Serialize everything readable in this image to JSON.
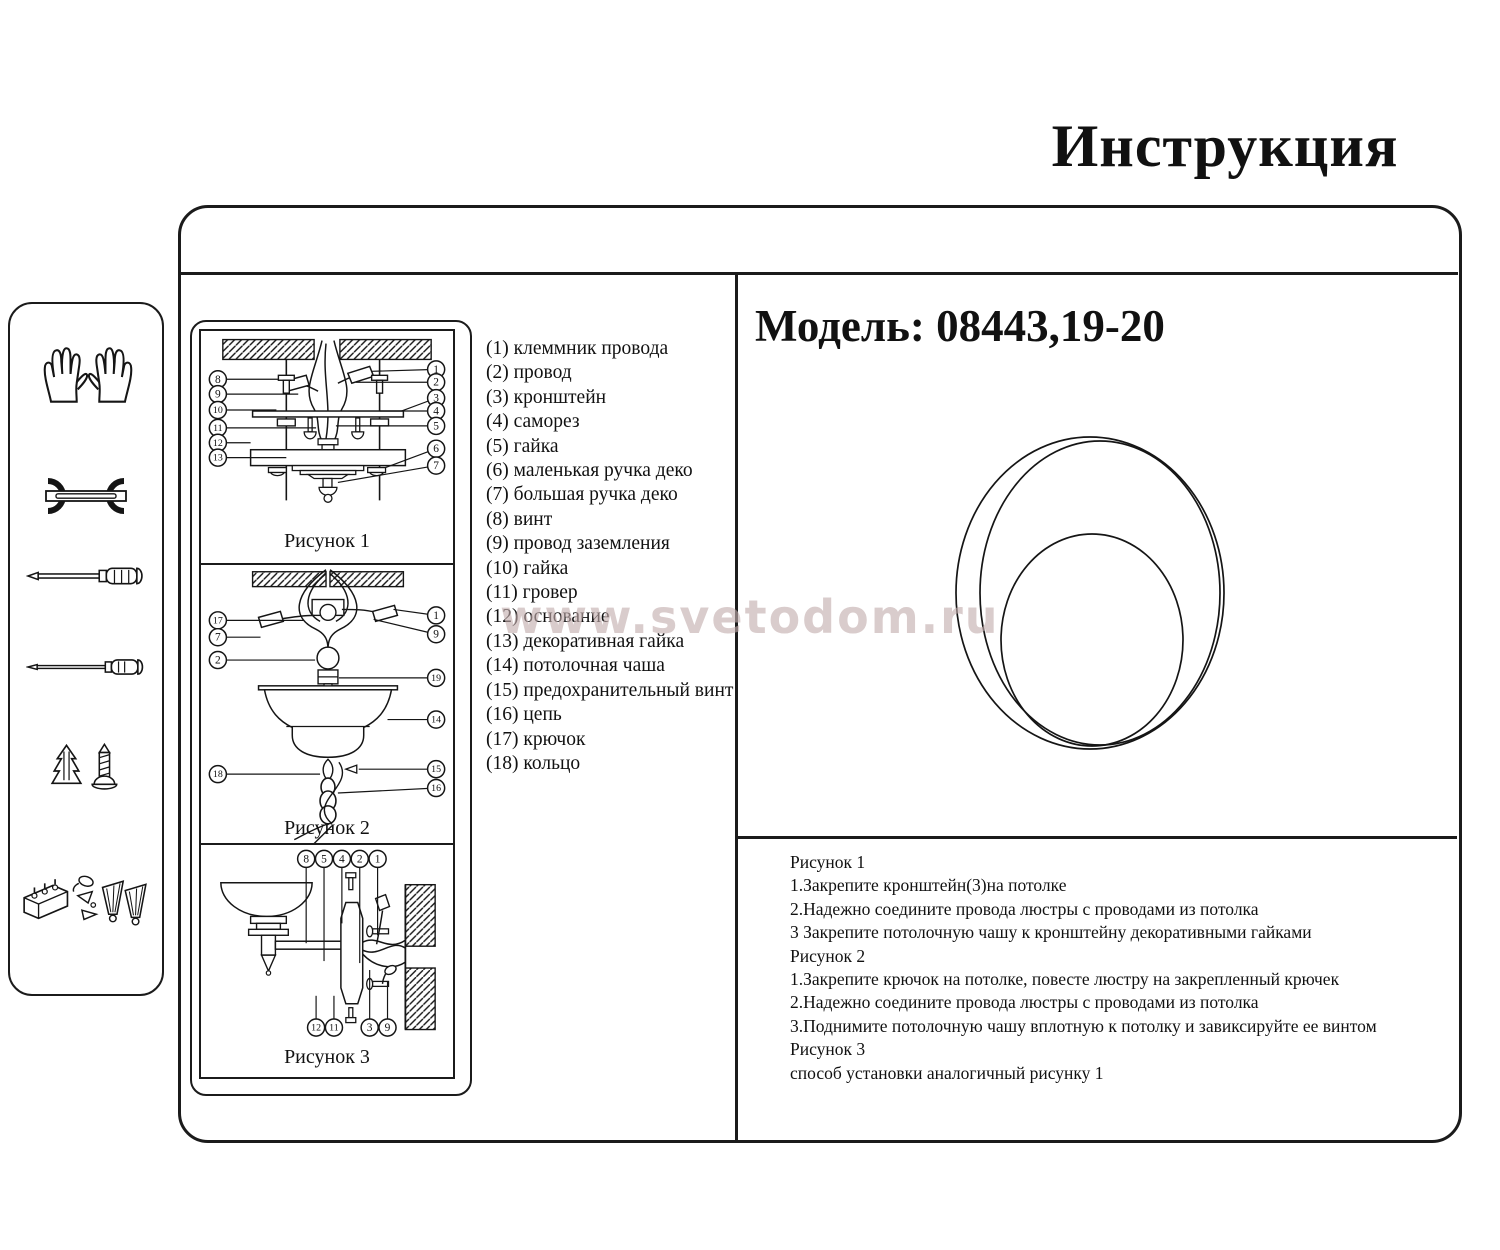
{
  "title": "Инструкция",
  "watermark": "www.svetodom.ru",
  "model": {
    "label": "Модель:",
    "value": "08443,19-20"
  },
  "sidebar": {
    "tools": [
      "gloves-icon",
      "wrench-icon",
      "screwdriver-icon",
      "slim-screwdriver-icon",
      "wall-plug-and-screw-icon",
      "terminal-block-and-anchors-icon"
    ]
  },
  "parts": [
    {
      "num": "(1)",
      "name": "клеммник провода"
    },
    {
      "num": "(2)",
      "name": "провод"
    },
    {
      "num": "(3)",
      "name": "кронштейн"
    },
    {
      "num": "(4)",
      "name": "саморез"
    },
    {
      "num": "(5)",
      "name": "гайка"
    },
    {
      "num": "(6)",
      "name": "маленькая ручка деко"
    },
    {
      "num": "(7)",
      "name": "большая ручка деко"
    },
    {
      "num": "(8)",
      "name": "винт"
    },
    {
      "num": "(9)",
      "name": "провод заземления"
    },
    {
      "num": "(10)",
      "name": "гайка"
    },
    {
      "num": "(11)",
      "name": "гровер"
    },
    {
      "num": "(12)",
      "name": "основание"
    },
    {
      "num": "(13)",
      "name": "декоративная гайка"
    },
    {
      "num": "(14)",
      "name": "потолочная чаша"
    },
    {
      "num": "(15)",
      "name": "предохранительный винт"
    },
    {
      "num": "(16)",
      "name": "цепь"
    },
    {
      "num": "(17)",
      "name": "крючок"
    },
    {
      "num": "(18)",
      "name": "кольцо"
    }
  ],
  "figures": [
    {
      "caption": "Рисунок 1",
      "callouts_left": [
        "8",
        "9",
        "10",
        "11",
        "12",
        "13"
      ],
      "callouts_right": [
        "1",
        "2",
        "3",
        "4",
        "5",
        "6",
        "7"
      ]
    },
    {
      "caption": "Рисунок 2",
      "callouts_left": [
        "17",
        "7",
        "2",
        "18"
      ],
      "callouts_right": [
        "1",
        "9",
        "19",
        "14",
        "15",
        "16"
      ]
    },
    {
      "caption": "Рисунок 3",
      "callouts_top": [
        "8",
        "5",
        "4",
        "2",
        "1"
      ],
      "callouts_bottom": [
        "12",
        "11",
        "3",
        "9"
      ]
    }
  ],
  "instructions": [
    "Рисунок 1",
    "1.Закрепите кронштейн(3)на потолке",
    "2.Надежно соедините провода люстры с проводами из потолка",
    "3 Закрепите потолочную чашу к кронштейну декоративными гайками",
    "Рисунок 2",
    "1.Закрепите крючок на потолке, повесте люстру на закрепленный крючек",
    "2.Надежно соедините провода люстры с проводами из потолка",
    "3.Поднимите потолочную чашу вплотную к потолку и завиксируйте ее винтом",
    "Рисунок 3",
    "способ установки аналогичный рисунку 1"
  ]
}
